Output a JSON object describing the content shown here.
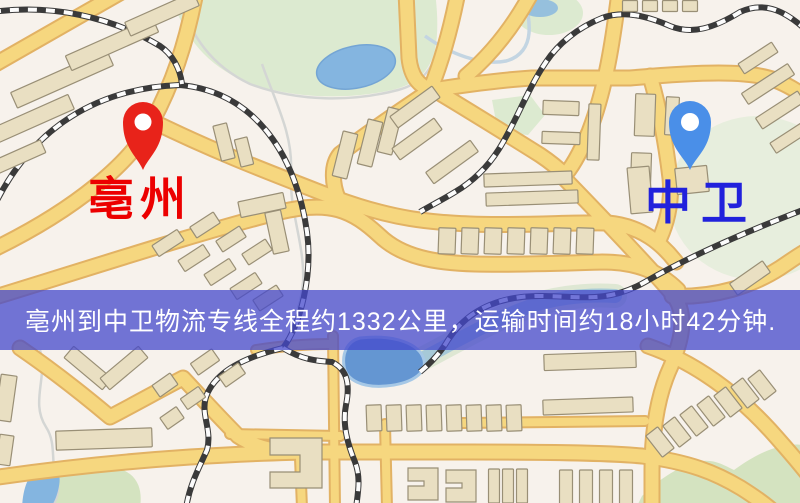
{
  "map": {
    "origin": {
      "label": "亳州"
    },
    "destination": {
      "label": "中卫"
    },
    "banner": {
      "text": "亳州到中卫物流专线全程约1332公里，运输时间约18小时42分钟."
    }
  },
  "colors": {
    "background": "#f7f2ec",
    "green": "#dcead0",
    "green_light": "#e7eedd",
    "green_dark": "#d4e3c0",
    "stream_gray": "#d4d6d4",
    "stream_blue": "#c3d5e2",
    "water": "#84b5e0",
    "water_stroke": "#74a5d4",
    "lake": "#6496d2",
    "lake_rim": "#a6c8e6",
    "river": "#8fbcd8",
    "river_bank": "#cadfbf",
    "road_casing": "#e2b264",
    "road_fill": "#f6d77f",
    "railway_dark": "#3a3a3a",
    "railway_light": "#fcfcfc",
    "building_fill": "#e9dfc2",
    "building_stroke": "#998f76",
    "pin_red": "#e8231a",
    "pin_blue": "#4a8fe8",
    "label_red": "#ec0000",
    "label_blue": "#2121dc",
    "banner_bg": "rgba(68,72,204,0.75)",
    "banner_text": "#ffffff"
  }
}
